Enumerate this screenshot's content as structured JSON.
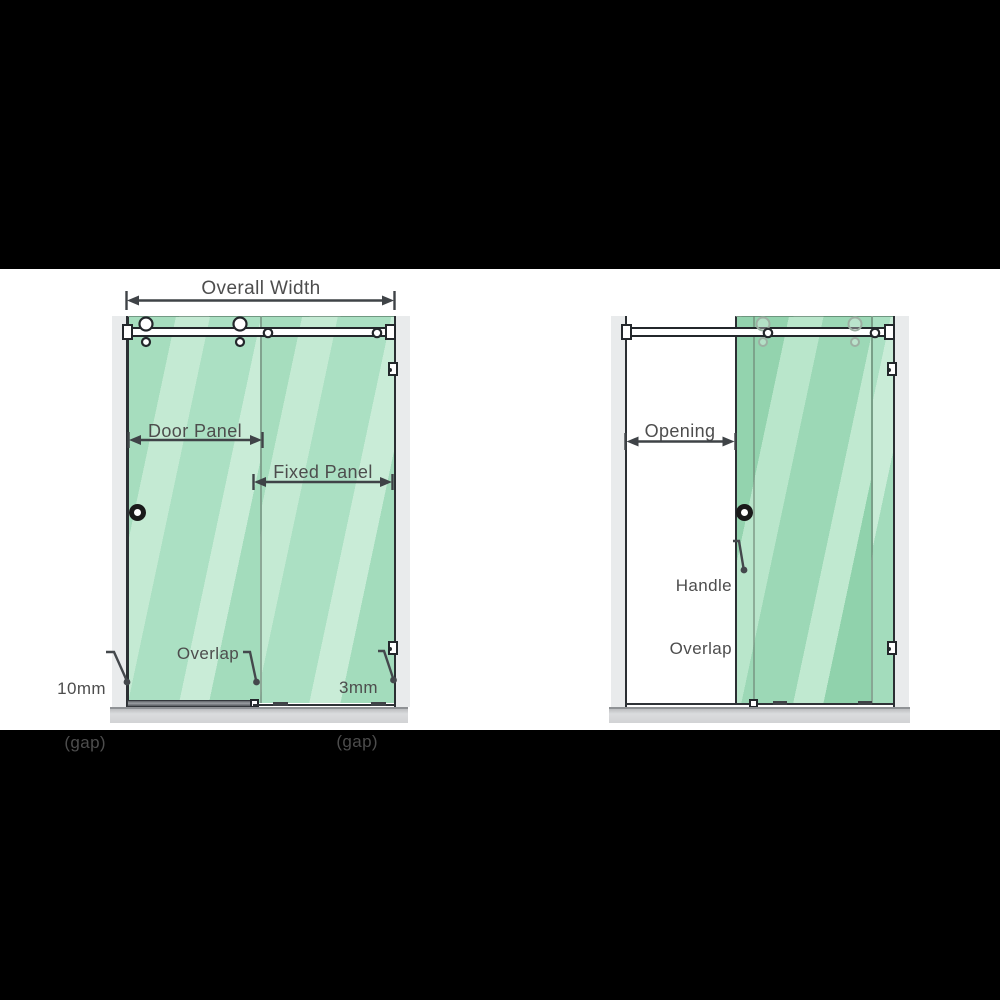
{
  "labels": {
    "left": {
      "overall_width": "Overall Width",
      "door_panel": "Door Panel",
      "fixed_panel": "Fixed Panel",
      "gap_left_value": "10mm",
      "gap_left_unit": "(gap)",
      "overlap": "Overlap",
      "gap_right_value": "3mm",
      "gap_right_unit": "(gap)"
    },
    "right": {
      "opening": "Opening",
      "handle_line1": "Handle",
      "handle_line2": "Overlap"
    }
  },
  "colors": {
    "letterbox": "#000000",
    "canvas": "#ffffff",
    "glass": "#aadfc2",
    "glass_stripe": "#c6ebd5",
    "glass_door_slid": "#97d6b2",
    "wall": "#e9ebec",
    "base_tray": "#d6d7d9",
    "outline": "#2b2f33",
    "dimension_lines": "#3f4347",
    "label_text": "#4d4d4d"
  }
}
